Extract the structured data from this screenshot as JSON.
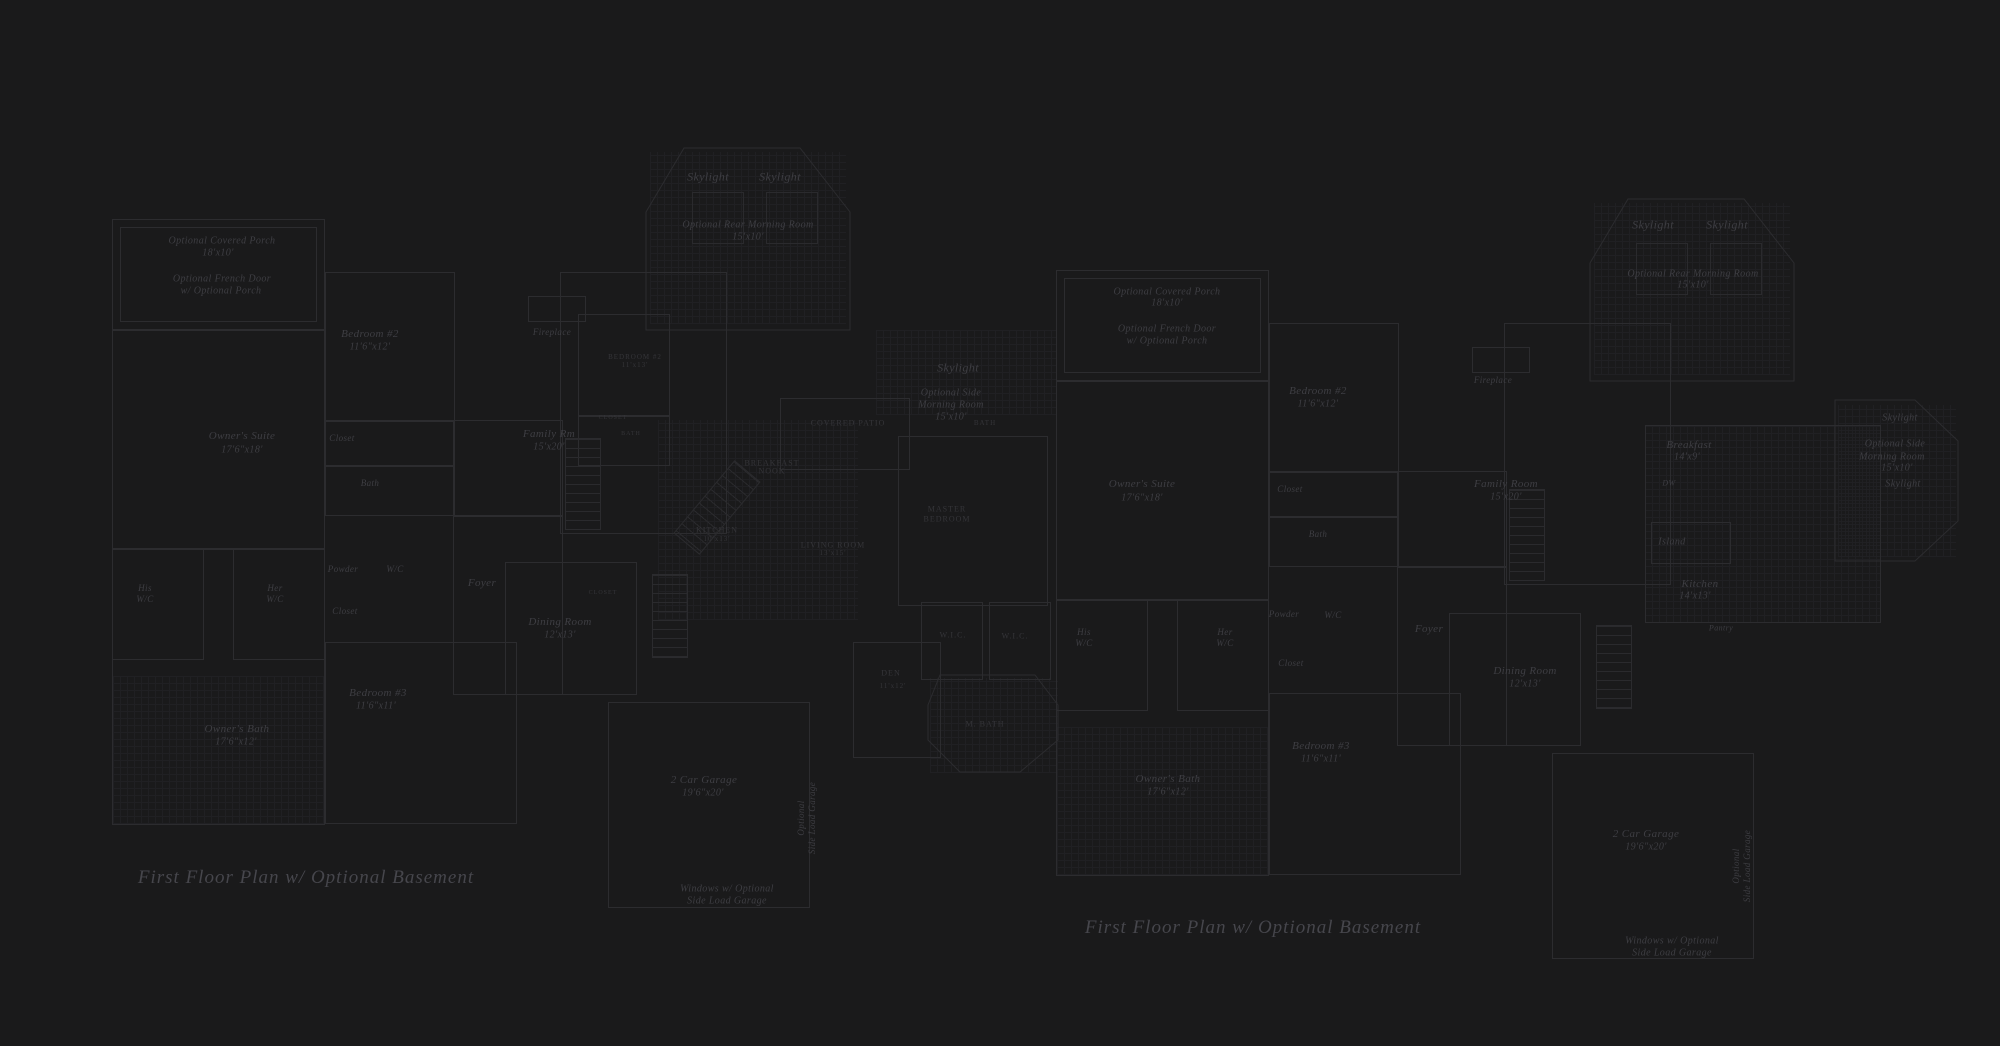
{
  "meta": {
    "description": "Two faint architectural blueprint drawings on dark background",
    "colors": {
      "background": "#1a1a1b",
      "line": "#2c2c2f",
      "grid": "#222225",
      "label_text": "#3e3e43",
      "caps_text": "#353539",
      "title_text": "#46464c"
    }
  },
  "plans": [
    {
      "title": {
        "text": "First Floor Plan  w/ Optional Basement",
        "x": 306,
        "y": 878
      },
      "labels": [
        {
          "t": "Optional Covered Porch",
          "x": 222,
          "y": 241,
          "s": 10
        },
        {
          "t": "18'x10'",
          "x": 218,
          "y": 253,
          "s": 10
        },
        {
          "t": "Optional French Door",
          "x": 222,
          "y": 279,
          "s": 10
        },
        {
          "t": "w/ Optional Porch",
          "x": 221,
          "y": 291,
          "s": 10
        },
        {
          "t": "Skylight",
          "x": 708,
          "y": 177,
          "s": 12
        },
        {
          "t": "Skylight",
          "x": 780,
          "y": 177,
          "s": 12
        },
        {
          "t": "Optional Rear Morning Room",
          "x": 748,
          "y": 225,
          "s": 10
        },
        {
          "t": "15'x10'",
          "x": 748,
          "y": 237,
          "s": 10
        },
        {
          "t": "Fireplace",
          "x": 552,
          "y": 332,
          "s": 9
        },
        {
          "t": "Bedroom #2",
          "x": 370,
          "y": 334,
          "s": 11
        },
        {
          "t": "11'6\"x12'",
          "x": 370,
          "y": 347,
          "s": 10
        },
        {
          "t": "Closet",
          "x": 342,
          "y": 438,
          "s": 9
        },
        {
          "t": "Bath",
          "x": 370,
          "y": 483,
          "s": 9
        },
        {
          "t": "Owner's Suite",
          "x": 242,
          "y": 436,
          "s": 11
        },
        {
          "t": "17'6\"x18'",
          "x": 242,
          "y": 450,
          "s": 10
        },
        {
          "t": "Family Rm",
          "x": 549,
          "y": 434,
          "s": 11
        },
        {
          "t": "15'x20'",
          "x": 549,
          "y": 447,
          "s": 10
        },
        {
          "t": "His",
          "x": 145,
          "y": 588,
          "s": 9
        },
        {
          "t": "W/C",
          "x": 145,
          "y": 599,
          "s": 9
        },
        {
          "t": "Her",
          "x": 275,
          "y": 588,
          "s": 9
        },
        {
          "t": "W/C",
          "x": 275,
          "y": 599,
          "s": 9
        },
        {
          "t": "Powder",
          "x": 343,
          "y": 569,
          "s": 9
        },
        {
          "t": "W/C",
          "x": 395,
          "y": 569,
          "s": 9
        },
        {
          "t": "Closet",
          "x": 345,
          "y": 611,
          "s": 9
        },
        {
          "t": "Foyer",
          "x": 482,
          "y": 583,
          "s": 11
        },
        {
          "t": "Dining Room",
          "x": 560,
          "y": 622,
          "s": 11
        },
        {
          "t": "12'x13'",
          "x": 560,
          "y": 635,
          "s": 10
        },
        {
          "t": "Bedroom #3",
          "x": 378,
          "y": 693,
          "s": 11
        },
        {
          "t": "11'6\"x11'",
          "x": 376,
          "y": 706,
          "s": 10
        },
        {
          "t": "Owner's Bath",
          "x": 237,
          "y": 729,
          "s": 11
        },
        {
          "t": "17'6\"x12'",
          "x": 236,
          "y": 742,
          "s": 10
        },
        {
          "t": "2 Car Garage",
          "x": 704,
          "y": 780,
          "s": 11
        },
        {
          "t": "19'6\"x20'",
          "x": 703,
          "y": 793,
          "s": 10
        },
        {
          "t": "Optional",
          "x": 801,
          "y": 818,
          "s": 9,
          "r": -90
        },
        {
          "t": "Side Load Garage",
          "x": 812,
          "y": 818,
          "s": 9,
          "r": -90
        },
        {
          "t": "Windows w/ Optional",
          "x": 727,
          "y": 889,
          "s": 10
        },
        {
          "t": "Side Load Garage",
          "x": 727,
          "y": 901,
          "s": 10
        },
        {
          "t": "Skylight",
          "x": 958,
          "y": 368,
          "s": 12
        },
        {
          "t": "Optional Side",
          "x": 951,
          "y": 393,
          "s": 10
        },
        {
          "t": "Morning Room",
          "x": 951,
          "y": 405,
          "s": 10
        },
        {
          "t": "15'x10'",
          "x": 951,
          "y": 417,
          "s": 10
        },
        {
          "t": "COVERED PATIO",
          "x": 848,
          "y": 423,
          "s": 8,
          "c": "caps"
        },
        {
          "t": "BREAKFAST",
          "x": 772,
          "y": 463,
          "s": 8,
          "c": "caps"
        },
        {
          "t": "NOOK",
          "x": 772,
          "y": 471,
          "s": 8,
          "c": "caps"
        },
        {
          "t": "KITCHEN",
          "x": 717,
          "y": 530,
          "s": 8,
          "c": "caps"
        },
        {
          "t": "10'x13'",
          "x": 717,
          "y": 539,
          "s": 7,
          "c": "caps"
        },
        {
          "t": "LIVING ROOM",
          "x": 833,
          "y": 545,
          "s": 8,
          "c": "caps"
        },
        {
          "t": "13'x15'",
          "x": 833,
          "y": 553,
          "s": 7,
          "c": "caps"
        },
        {
          "t": "BEDROOM #2",
          "x": 635,
          "y": 357,
          "s": 7,
          "c": "caps"
        },
        {
          "t": "11'x13'",
          "x": 635,
          "y": 365,
          "s": 7,
          "c": "caps"
        },
        {
          "t": "CLOSET",
          "x": 613,
          "y": 418,
          "s": 6,
          "c": "caps"
        },
        {
          "t": "BATH",
          "x": 631,
          "y": 434,
          "s": 6,
          "c": "caps"
        },
        {
          "t": "CLOSET",
          "x": 603,
          "y": 593,
          "s": 6,
          "c": "caps"
        },
        {
          "t": "BATH",
          "x": 985,
          "y": 423,
          "s": 7,
          "c": "caps"
        },
        {
          "t": "W.I.C.",
          "x": 953,
          "y": 635,
          "s": 8,
          "c": "caps"
        },
        {
          "t": "W.I.C.",
          "x": 1015,
          "y": 636,
          "s": 8,
          "c": "caps"
        },
        {
          "t": "DEN",
          "x": 891,
          "y": 673,
          "s": 8,
          "c": "caps"
        },
        {
          "t": "11'x12'",
          "x": 893,
          "y": 686,
          "s": 7,
          "c": "caps"
        },
        {
          "t": "M. BATH",
          "x": 985,
          "y": 724,
          "s": 8,
          "c": "caps"
        },
        {
          "t": "MASTER",
          "x": 947,
          "y": 509,
          "s": 8,
          "c": "caps"
        },
        {
          "t": "BEDROOM",
          "x": 947,
          "y": 519,
          "s": 8,
          "c": "caps"
        }
      ],
      "walls": [
        [
          112,
          219,
          213,
          111
        ],
        [
          120,
          227,
          197,
          95
        ],
        [
          112,
          330,
          213,
          495
        ],
        [
          112,
          548,
          213,
          1
        ],
        [
          112,
          548,
          92,
          112
        ],
        [
          233,
          548,
          92,
          112
        ],
        [
          325,
          272,
          130,
          244
        ],
        [
          325,
          420,
          130,
          1
        ],
        [
          325,
          465,
          130,
          1
        ],
        [
          325,
          642,
          192,
          182
        ],
        [
          453,
          420,
          110,
          275
        ],
        [
          453,
          515,
          110,
          1
        ],
        [
          560,
          272,
          167,
          262
        ],
        [
          528,
          296,
          58,
          26
        ],
        [
          505,
          562,
          132,
          133
        ],
        [
          608,
          702,
          202,
          206
        ],
        [
          578,
          314,
          92,
          102
        ],
        [
          578,
          416,
          92,
          50
        ],
        [
          898,
          436,
          150,
          170
        ],
        [
          853,
          642,
          88,
          116
        ],
        [
          921,
          602,
          62,
          78
        ],
        [
          989,
          602,
          62,
          78
        ],
        [
          780,
          398,
          130,
          72
        ]
      ],
      "skylights": [
        [
          692,
          192,
          52,
          52
        ],
        [
          766,
          192,
          52,
          52
        ]
      ],
      "grids": [
        [
          113,
          676,
          211,
          148
        ],
        [
          658,
          420,
          200,
          200
        ],
        [
          876,
          330,
          180,
          85
        ],
        [
          930,
          678,
          128,
          95
        ],
        [
          650,
          152,
          196,
          172
        ]
      ],
      "stairs": [
        {
          "b": [
            565,
            438,
            36,
            92
          ]
        },
        {
          "b": [
            652,
            574,
            36,
            84
          ]
        },
        {
          "b": [
            700,
            460,
            34,
            95
          ],
          "r": 40
        }
      ],
      "polys": [
        [
          [
            646,
            212
          ],
          [
            684,
            148
          ],
          [
            800,
            148
          ],
          [
            850,
            212
          ],
          [
            850,
            330
          ],
          [
            646,
            330
          ]
        ],
        [
          [
            940,
            675
          ],
          [
            1035,
            675
          ],
          [
            1058,
            705
          ],
          [
            1058,
            740
          ],
          [
            1020,
            772
          ],
          [
            960,
            772
          ],
          [
            928,
            740
          ],
          [
            928,
            705
          ]
        ]
      ]
    },
    {
      "title": {
        "text": "First Floor Plan  w/ Optional Basement",
        "x": 1253,
        "y": 928
      },
      "labels": [
        {
          "t": "Optional Covered Porch",
          "x": 1167,
          "y": 292,
          "s": 10
        },
        {
          "t": "18'x10'",
          "x": 1167,
          "y": 303,
          "s": 10
        },
        {
          "t": "Optional French Door",
          "x": 1167,
          "y": 329,
          "s": 10
        },
        {
          "t": "w/ Optional Porch",
          "x": 1167,
          "y": 341,
          "s": 10
        },
        {
          "t": "Skylight",
          "x": 1653,
          "y": 225,
          "s": 12
        },
        {
          "t": "Skylight",
          "x": 1727,
          "y": 225,
          "s": 12
        },
        {
          "t": "Optional Rear Morning Room",
          "x": 1693,
          "y": 274,
          "s": 10
        },
        {
          "t": "15'x10'",
          "x": 1693,
          "y": 285,
          "s": 10
        },
        {
          "t": "Fireplace",
          "x": 1493,
          "y": 380,
          "s": 9
        },
        {
          "t": "Bedroom #2",
          "x": 1318,
          "y": 391,
          "s": 11
        },
        {
          "t": "11'6\"x12'",
          "x": 1318,
          "y": 404,
          "s": 10
        },
        {
          "t": "Closet",
          "x": 1290,
          "y": 489,
          "s": 9
        },
        {
          "t": "Bath",
          "x": 1318,
          "y": 534,
          "s": 9
        },
        {
          "t": "Owner's Suite",
          "x": 1142,
          "y": 484,
          "s": 11
        },
        {
          "t": "17'6\"x18'",
          "x": 1142,
          "y": 498,
          "s": 10
        },
        {
          "t": "Family Room",
          "x": 1506,
          "y": 484,
          "s": 11
        },
        {
          "t": "15'x20'",
          "x": 1506,
          "y": 497,
          "s": 10
        },
        {
          "t": "His",
          "x": 1084,
          "y": 632,
          "s": 9
        },
        {
          "t": "W/C",
          "x": 1084,
          "y": 643,
          "s": 9
        },
        {
          "t": "Her",
          "x": 1225,
          "y": 632,
          "s": 9
        },
        {
          "t": "W/C",
          "x": 1225,
          "y": 643,
          "s": 9
        },
        {
          "t": "Powder",
          "x": 1284,
          "y": 614,
          "s": 9
        },
        {
          "t": "W/C",
          "x": 1333,
          "y": 615,
          "s": 9
        },
        {
          "t": "Closet",
          "x": 1291,
          "y": 663,
          "s": 9
        },
        {
          "t": "Foyer",
          "x": 1429,
          "y": 629,
          "s": 11
        },
        {
          "t": "Dining Room",
          "x": 1525,
          "y": 671,
          "s": 11
        },
        {
          "t": "12'x13'",
          "x": 1525,
          "y": 684,
          "s": 10
        },
        {
          "t": "Bedroom #3",
          "x": 1321,
          "y": 746,
          "s": 11
        },
        {
          "t": "11'6\"x11'",
          "x": 1321,
          "y": 759,
          "s": 10
        },
        {
          "t": "Owner's Bath",
          "x": 1168,
          "y": 779,
          "s": 11
        },
        {
          "t": "17'6\"x12'",
          "x": 1168,
          "y": 792,
          "s": 10
        },
        {
          "t": "2 Car Garage",
          "x": 1646,
          "y": 834,
          "s": 11
        },
        {
          "t": "19'6\"x20'",
          "x": 1646,
          "y": 847,
          "s": 10
        },
        {
          "t": "Optional",
          "x": 1736,
          "y": 866,
          "s": 9,
          "r": -90
        },
        {
          "t": "Side Load Garage",
          "x": 1747,
          "y": 866,
          "s": 9,
          "r": -90
        },
        {
          "t": "Windows w/ Optional",
          "x": 1672,
          "y": 941,
          "s": 10
        },
        {
          "t": "Side Load Garage",
          "x": 1672,
          "y": 953,
          "s": 10
        },
        {
          "t": "Breakfast",
          "x": 1689,
          "y": 445,
          "s": 11
        },
        {
          "t": "14'x9'",
          "x": 1687,
          "y": 457,
          "s": 10
        },
        {
          "t": "DW",
          "x": 1669,
          "y": 483,
          "s": 8
        },
        {
          "t": "Island",
          "x": 1672,
          "y": 542,
          "s": 10
        },
        {
          "t": "Kitchen",
          "x": 1700,
          "y": 584,
          "s": 11
        },
        {
          "t": "14'x13'",
          "x": 1695,
          "y": 596,
          "s": 10
        },
        {
          "t": "Pantry",
          "x": 1721,
          "y": 628,
          "s": 8
        },
        {
          "t": "Skylight",
          "x": 1900,
          "y": 418,
          "s": 10
        },
        {
          "t": "Optional Side",
          "x": 1895,
          "y": 444,
          "s": 10
        },
        {
          "t": "Morning Room",
          "x": 1892,
          "y": 457,
          "s": 10
        },
        {
          "t": "15'x10'",
          "x": 1897,
          "y": 468,
          "s": 10
        },
        {
          "t": "Skylight",
          "x": 1903,
          "y": 484,
          "s": 10
        }
      ],
      "walls": [
        [
          1056,
          270,
          213,
          111
        ],
        [
          1064,
          278,
          197,
          95
        ],
        [
          1056,
          381,
          213,
          495
        ],
        [
          1056,
          599,
          213,
          1
        ],
        [
          1056,
          599,
          92,
          112
        ],
        [
          1177,
          599,
          92,
          112
        ],
        [
          1269,
          323,
          130,
          244
        ],
        [
          1269,
          471,
          130,
          1
        ],
        [
          1269,
          516,
          130,
          1
        ],
        [
          1269,
          693,
          192,
          182
        ],
        [
          1397,
          471,
          110,
          275
        ],
        [
          1397,
          566,
          110,
          1
        ],
        [
          1504,
          323,
          167,
          262
        ],
        [
          1472,
          347,
          58,
          26
        ],
        [
          1449,
          613,
          132,
          133
        ],
        [
          1552,
          753,
          202,
          206
        ],
        [
          1645,
          425,
          236,
          198
        ],
        [
          1651,
          522,
          80,
          42
        ]
      ],
      "skylights": [
        [
          1636,
          243,
          52,
          52
        ],
        [
          1710,
          243,
          52,
          52
        ]
      ],
      "grids": [
        [
          1057,
          727,
          211,
          148
        ],
        [
          1645,
          425,
          235,
          198
        ],
        [
          1838,
          405,
          118,
          152
        ],
        [
          1594,
          203,
          196,
          172
        ]
      ],
      "stairs": [
        {
          "b": [
            1509,
            489,
            36,
            92
          ]
        },
        {
          "b": [
            1596,
            625,
            36,
            84
          ]
        }
      ],
      "polys": [
        [
          [
            1590,
            263
          ],
          [
            1628,
            199
          ],
          [
            1744,
            199
          ],
          [
            1794,
            263
          ],
          [
            1794,
            381
          ],
          [
            1590,
            381
          ]
        ],
        [
          [
            1835,
            400
          ],
          [
            1915,
            400
          ],
          [
            1958,
            441
          ],
          [
            1958,
            521
          ],
          [
            1915,
            561
          ],
          [
            1835,
            561
          ]
        ]
      ]
    }
  ]
}
